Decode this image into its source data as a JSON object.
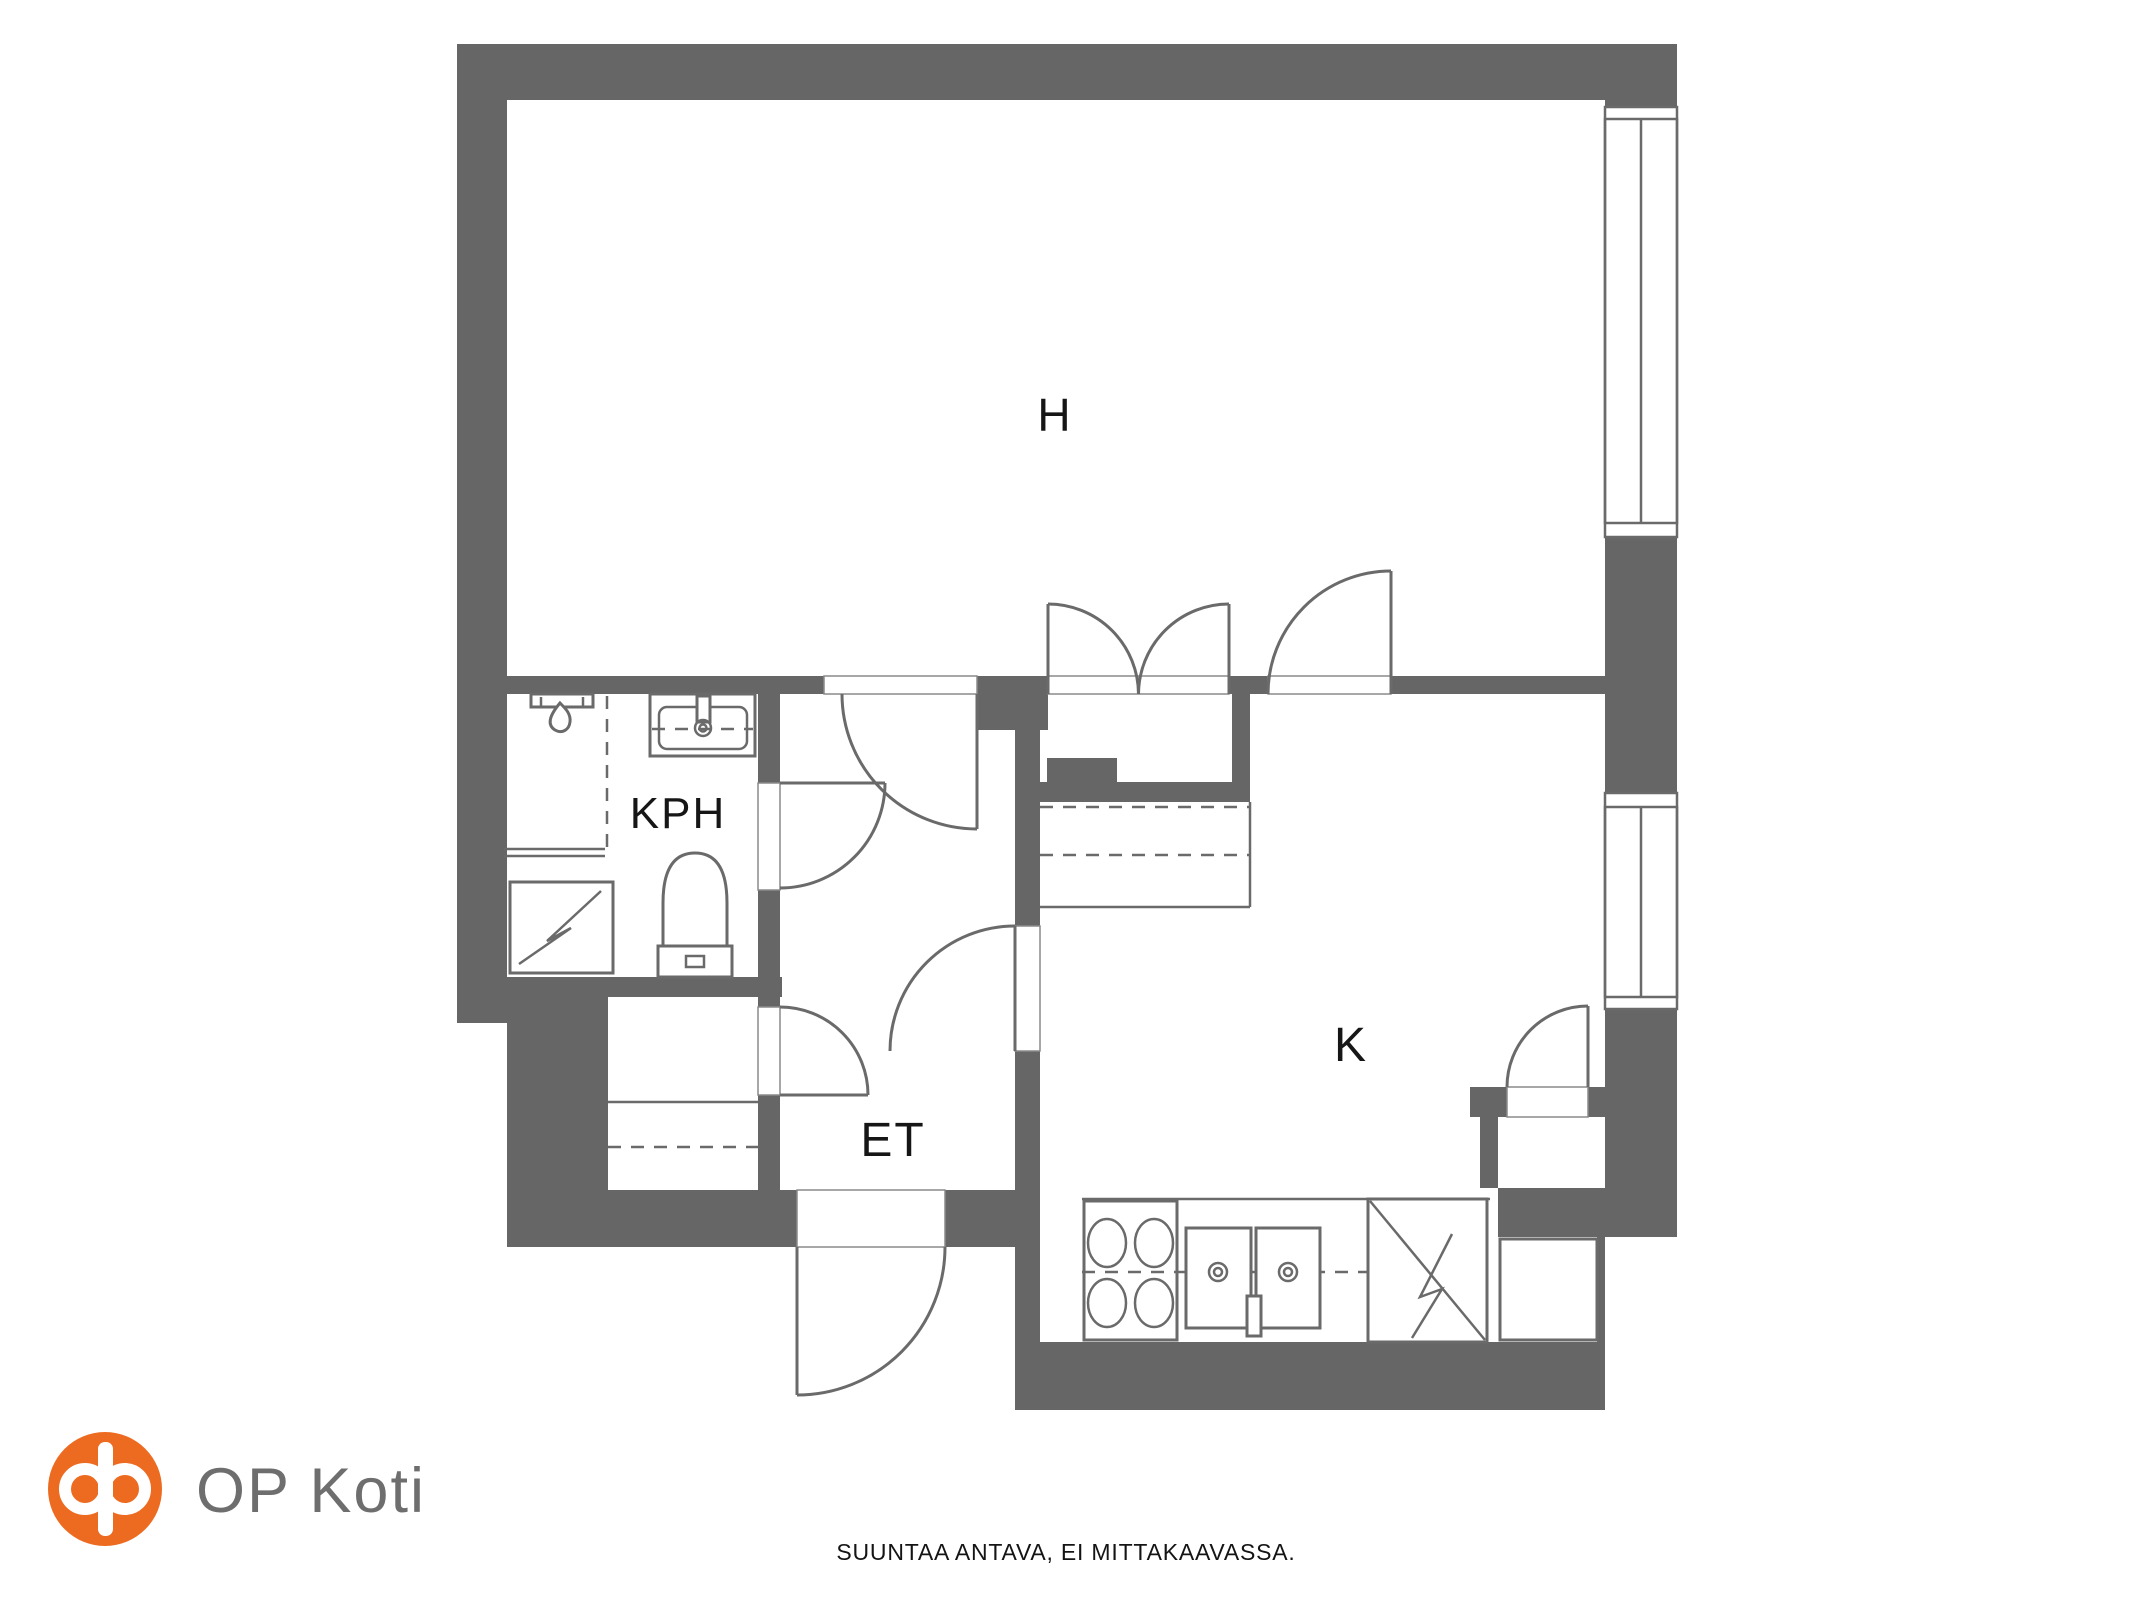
{
  "floorplan": {
    "rooms": [
      {
        "id": "h",
        "label": "H"
      },
      {
        "id": "kph",
        "label": "KPH"
      },
      {
        "id": "et",
        "label": "ET"
      },
      {
        "id": "k",
        "label": "K"
      }
    ],
    "disclaimer": "SUUNTAA ANTAVA, EI MITTAKAAVASSA."
  },
  "logo": {
    "brand": "OP Koti"
  },
  "colors": {
    "wall": "#666667",
    "fixture_line": "#6A6A6A",
    "label_text": "#161616",
    "logo_orange": "#ED6B21",
    "brand_text": "#6E6E6E"
  }
}
